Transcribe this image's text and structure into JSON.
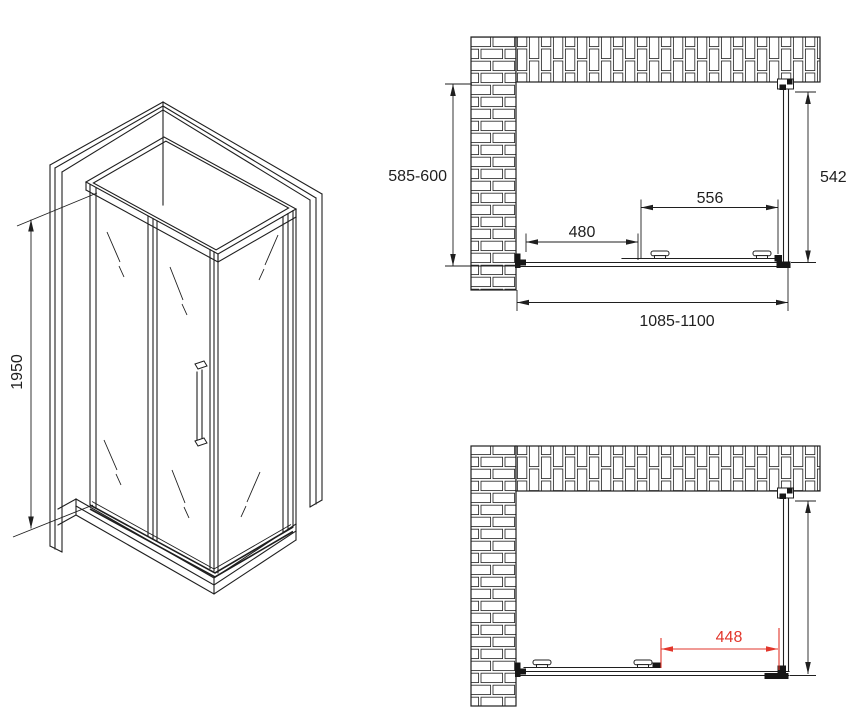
{
  "page": {
    "title": "Shower enclosure technical drawing",
    "background": "#ffffff",
    "line_color": "#1f1f1f",
    "accent_color": "#e2362b"
  },
  "isometric_view": {
    "height_dim_label": "1950"
  },
  "plan_view_closed": {
    "depth_dim_label": "585-600",
    "side_panel_dim_label": "542",
    "door_dim_label": "556",
    "fixed_panel_dim_label": "480",
    "overall_width_dim_label": "1085-1100"
  },
  "plan_view_open": {
    "opening_dim_label": "448"
  }
}
